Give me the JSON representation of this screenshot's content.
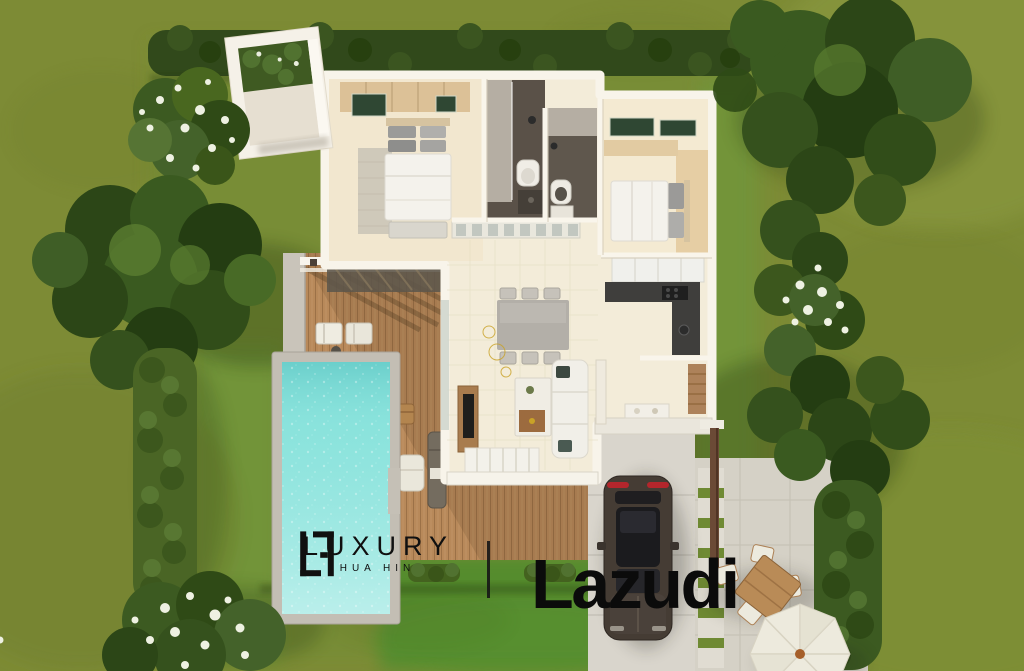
{
  "watermark": {
    "luxury": {
      "monogram_icon": "luxury-hua-hin-monogram-icon",
      "brand": "LUXURY",
      "location": "HUA HIN"
    },
    "divider_icon": "vertical-divider",
    "lazudi": {
      "brand": "Lazudi"
    }
  },
  "palette": {
    "grass_base": "#7d8b35",
    "lawn_bright": "#4f8c2e",
    "hedge_dark": "#31491b",
    "tree_green": "#3a5a20",
    "flower_white": "#eef1e2",
    "pool_water": "#8ce4dd",
    "pool_coping": "#c3beb4",
    "deck_wood": "#b8895a",
    "house_wall": "#f8f4ea",
    "interior_floor": "#f3ecd9",
    "bedroom_floor": "#f2e7cf",
    "bathroom_floor": "#5a5148",
    "kitchen_counter": "#3f3e3c",
    "driveway_concrete": "#d9d5cc",
    "car_body": "#453c34",
    "car_taillight": "#b3262c",
    "umbrella_canopy": "#edeadd",
    "watermark_ink": "#111111"
  }
}
